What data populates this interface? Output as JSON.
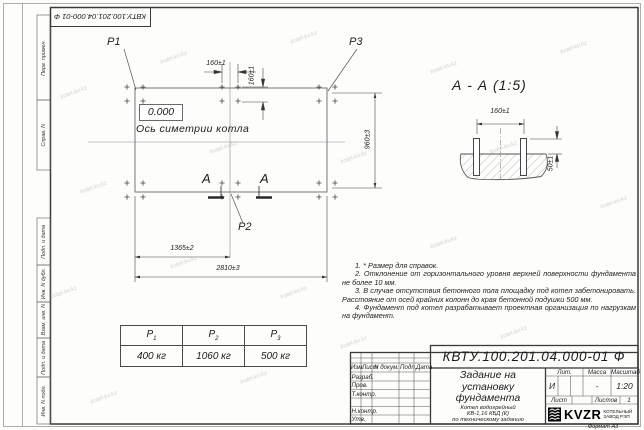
{
  "watermark": {
    "text": "kotel-kv.kz"
  },
  "frame": {
    "doc_number_top": "КВТУ.100.201.04.000-01 Ф",
    "side_labels": [
      "Перв. примен.",
      "Справ. N",
      "Подп. и дата",
      "Инв. N дубл.",
      "Взам. инв. N",
      "Подп. и дата",
      "Инв. N подл."
    ],
    "format_note": "Формат А3"
  },
  "plan": {
    "p1": "P1",
    "p2": "P2",
    "p3": "P3",
    "elevation": "0.000",
    "axis_label": "Ось симетрии котла",
    "section_letter": "А",
    "dim_top_160": "160±1",
    "dim_right_160": "160±1",
    "dim_height_960": "960±3",
    "dim_mid_1365": "1365±2",
    "dim_total_2810": "2810±3"
  },
  "section_view": {
    "title": "А - А (1:5)",
    "dim_bolts_160": "160±1",
    "dim_height_50": "50±1"
  },
  "notes": [
    "1. * Размер для справок.",
    "2. Отклонение от горизонтального уровня верхней поверхности фундамента не более 10 мм.",
    "3. В случае отсутствия бетонного пола площадку под котел забетонировать. Расстояние от осей крайних колонн до края бетонной подушки 500 мм.",
    "4. Фундамент под котел разрабатывает проектная организация по нагрузкам на фундамент."
  ],
  "load_table": {
    "columns": [
      {
        "symbol": "P",
        "sub": "1",
        "value": "400 кг"
      },
      {
        "symbol": "P",
        "sub": "2",
        "value": "1060 кг"
      },
      {
        "symbol": "P",
        "sub": "3",
        "value": "500 кг"
      }
    ]
  },
  "title_block": {
    "doc_number": "КВТУ.100.201.04.000-01 Ф",
    "title_lines": [
      "Задание на",
      "установку",
      "фундамента"
    ],
    "subtitle_lines": [
      "Котел водогрейный",
      "КВ-1,16 КБД (К)",
      "по техническому заданию"
    ],
    "header_cols": [
      "Изм.",
      "Лист",
      "N докум.",
      "Подп.",
      "Дата"
    ],
    "row_labels": [
      "Разраб.",
      "Пров.",
      "Т.контр.",
      "Н.контр.",
      "Утв."
    ],
    "lit_label": "Лит.",
    "mass_label": "Масса",
    "scale_label": "Масштаб",
    "lit_value": "И",
    "mass_value": "-",
    "scale_value": "1:20",
    "sheet_label": "Лист",
    "sheets_label": "Листов",
    "sheets_value": "1",
    "logo_text": "KVZR",
    "logo_sub_lines": [
      "КОТЕЛЬНЫЙ",
      "ЗАВОД РЭП"
    ]
  }
}
